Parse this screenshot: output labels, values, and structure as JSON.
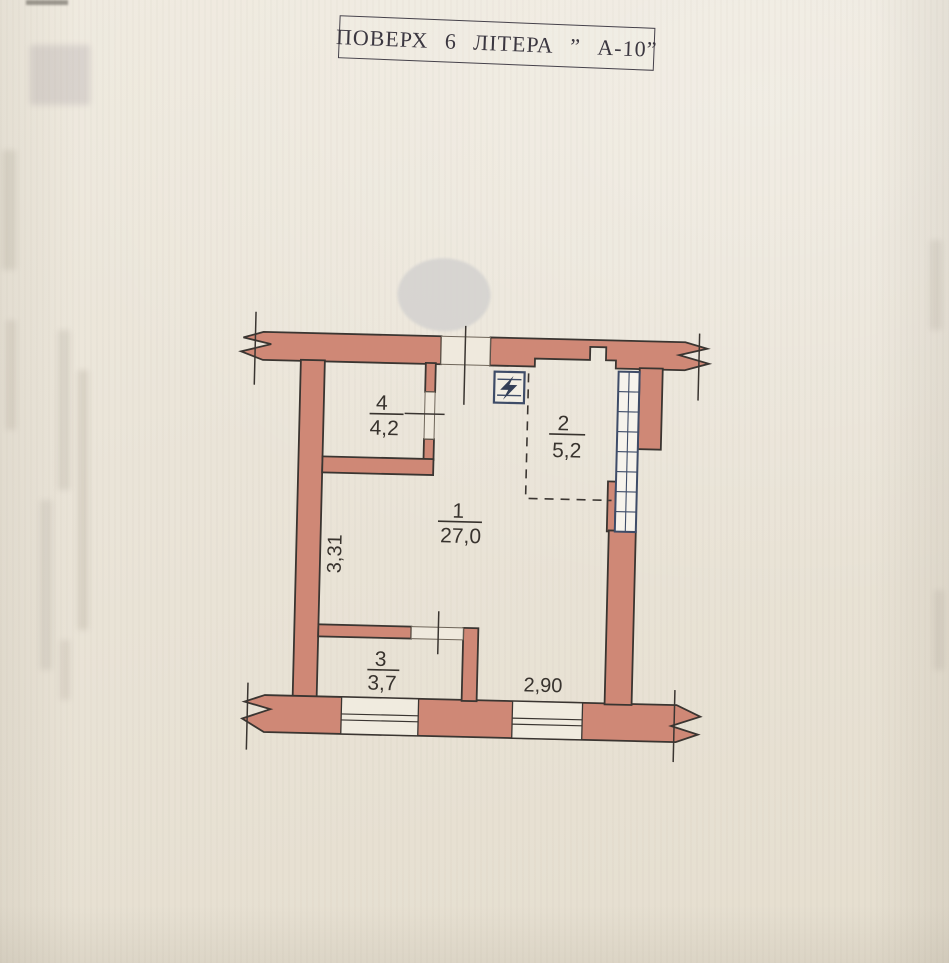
{
  "document": {
    "title": "ПОВЕРХ 6 ЛІТЕРА ” А-10”"
  },
  "floor_plan": {
    "rooms": [
      {
        "number": "1",
        "area": "27,0"
      },
      {
        "number": "2",
        "area": "5,2"
      },
      {
        "number": "3",
        "area": "3,7"
      },
      {
        "number": "4",
        "area": "4,2"
      }
    ],
    "dimensions": {
      "left_wall": "3,31",
      "bottom_wall": "2,90"
    },
    "symbols": [
      {
        "name": "electrical-panel-icon",
        "meaning": "electric panel with lightning bolt"
      }
    ],
    "colors": {
      "wall_fill": "#cf8876",
      "wall_outline": "#3a3531",
      "glazing_frame": "#3e4c68",
      "paper": "#eae4d8",
      "redaction_spot": "#d6d4d1"
    }
  }
}
